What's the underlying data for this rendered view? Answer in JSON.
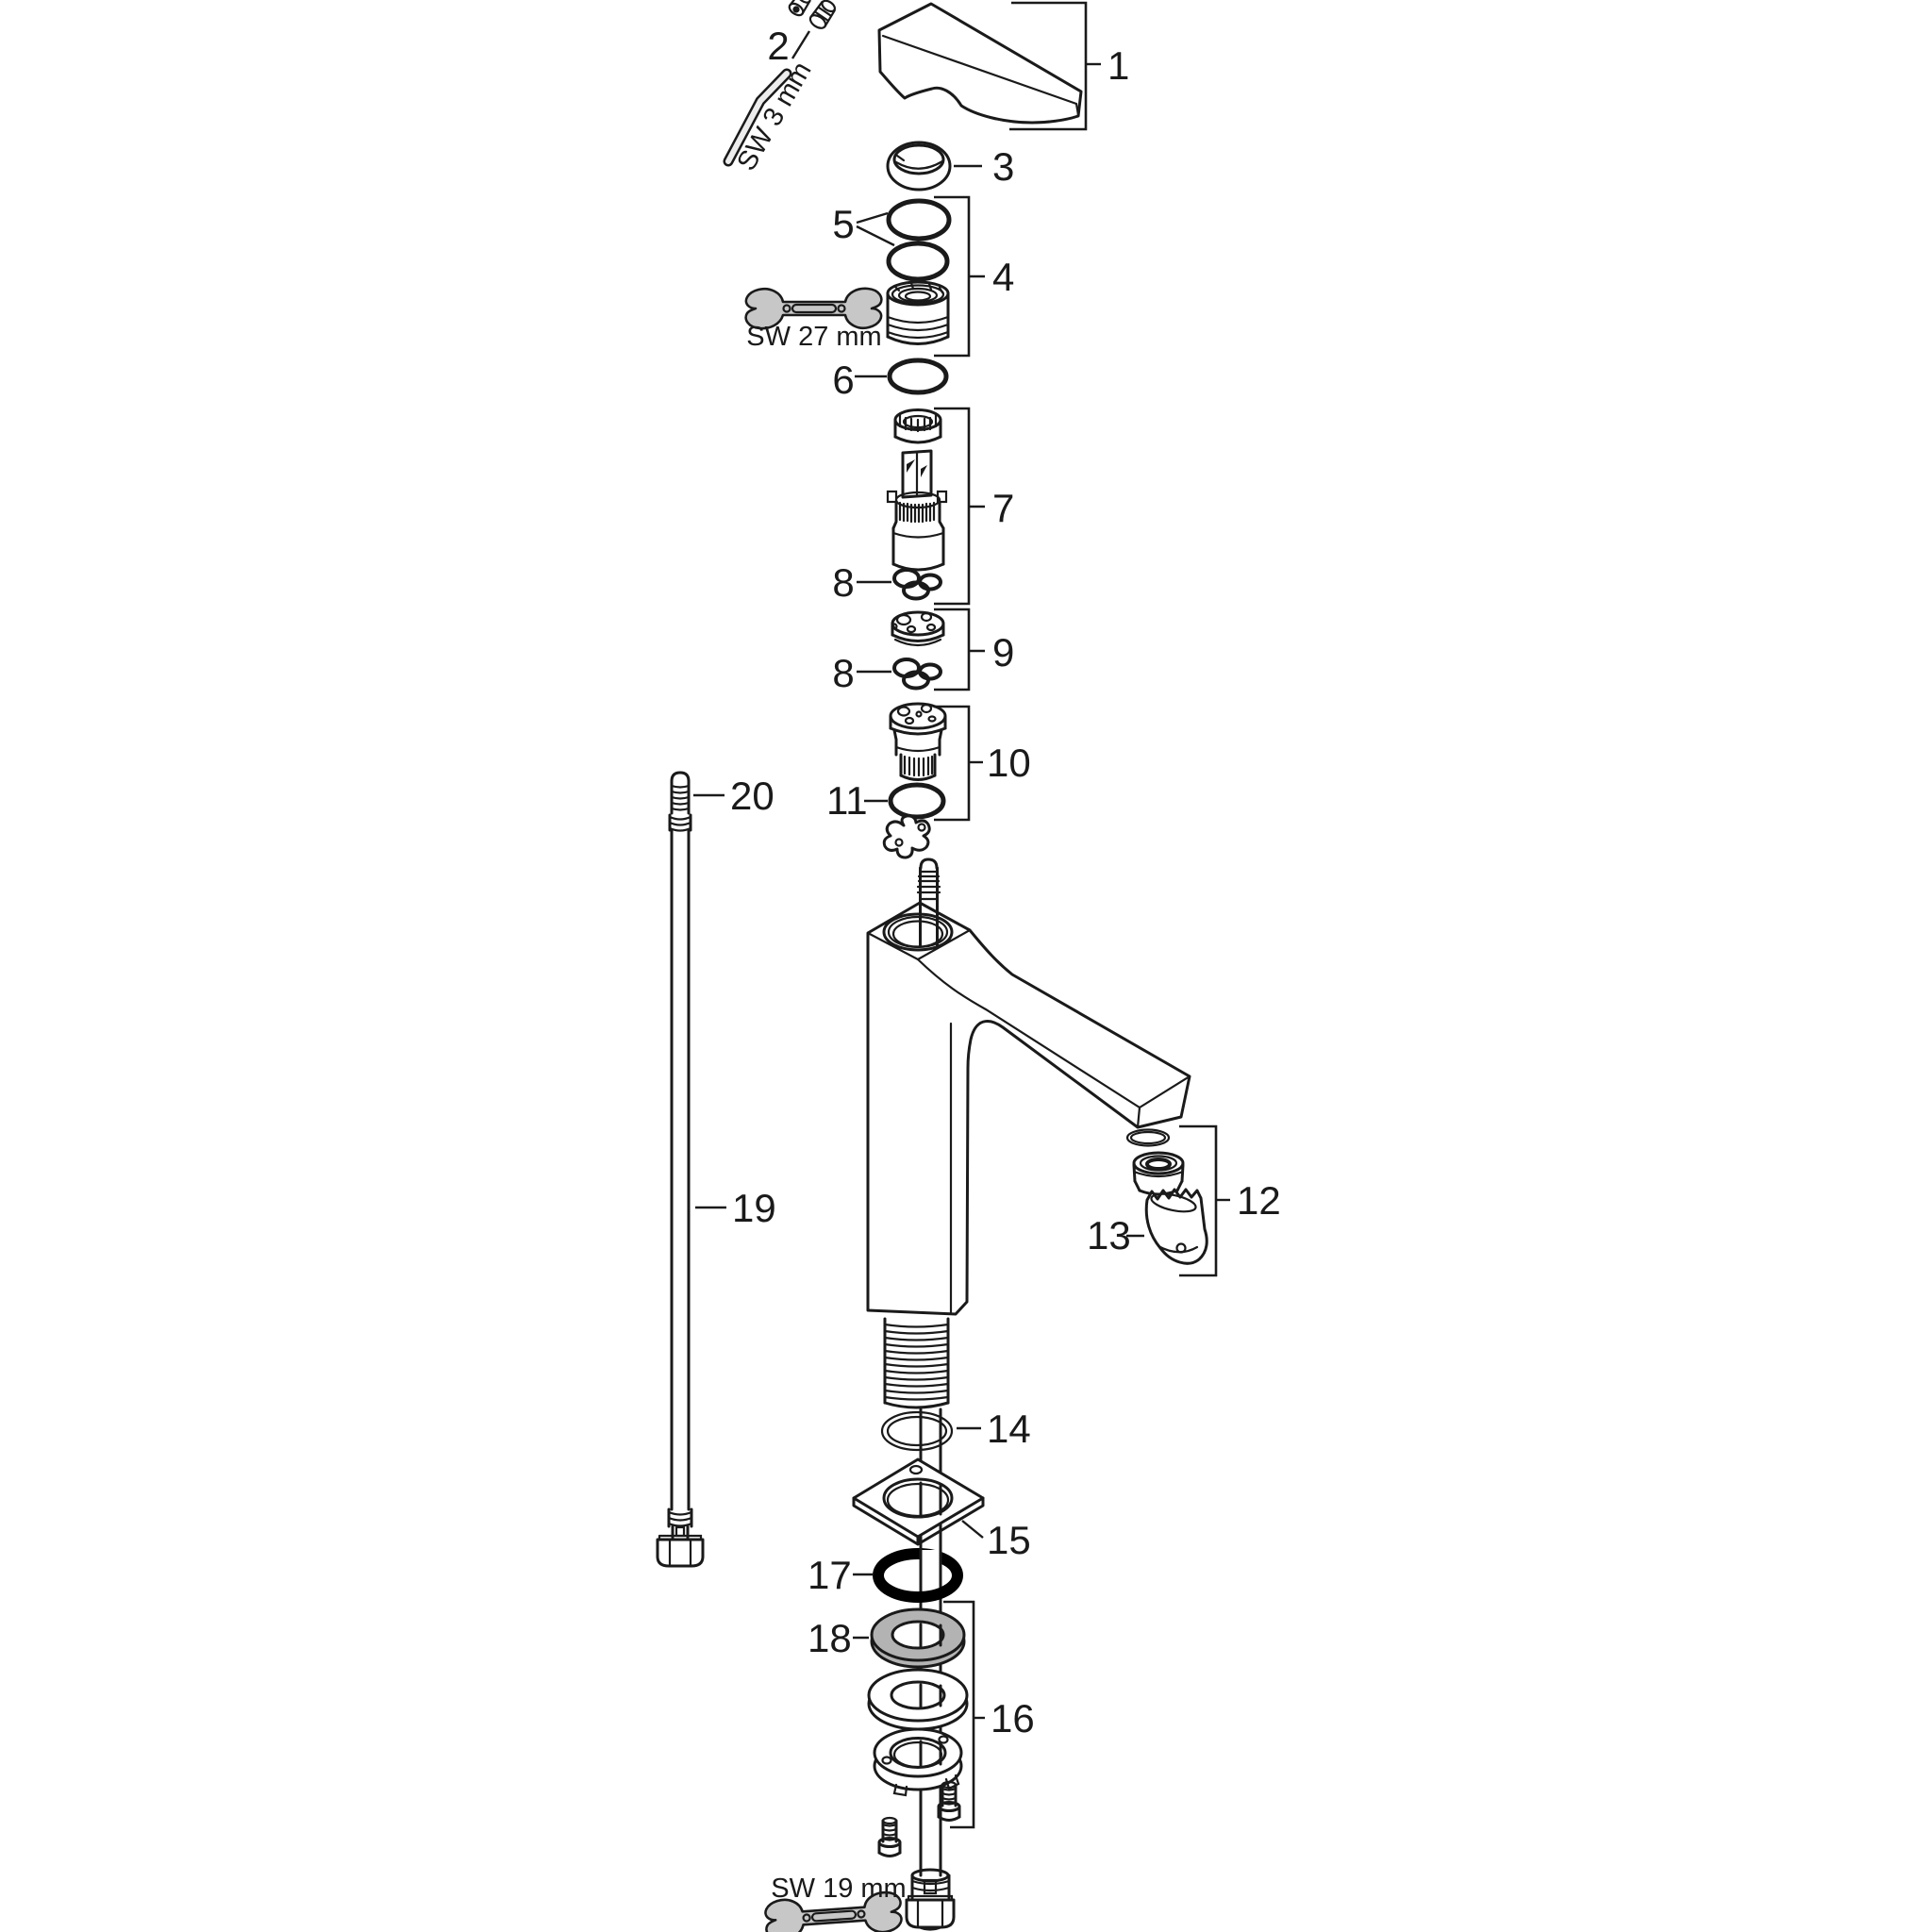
{
  "diagram": {
    "colors": {
      "background": "#ffffff",
      "line": "#1a1a1a",
      "tool_fill": "#c7c7c7",
      "washer_fill": "#b3b3b3",
      "seal_ring_17": "#000000"
    },
    "part_labels": {
      "p1": "1",
      "p2": "2",
      "p3": "3",
      "p4": "4",
      "p5": "5",
      "p6": "6",
      "p7": "7",
      "p8a": "8",
      "p8b": "8",
      "p9": "9",
      "p10": "10",
      "p11": "11",
      "p12": "12",
      "p13": "13",
      "p14": "14",
      "p15": "15",
      "p16": "16",
      "p17": "17",
      "p18": "18",
      "p19": "19",
      "p20": "20"
    },
    "tool_labels": {
      "allen_key": "SW 3 mm",
      "wrench_27": "SW 27 mm",
      "wrench_19": "SW 19 mm"
    }
  }
}
